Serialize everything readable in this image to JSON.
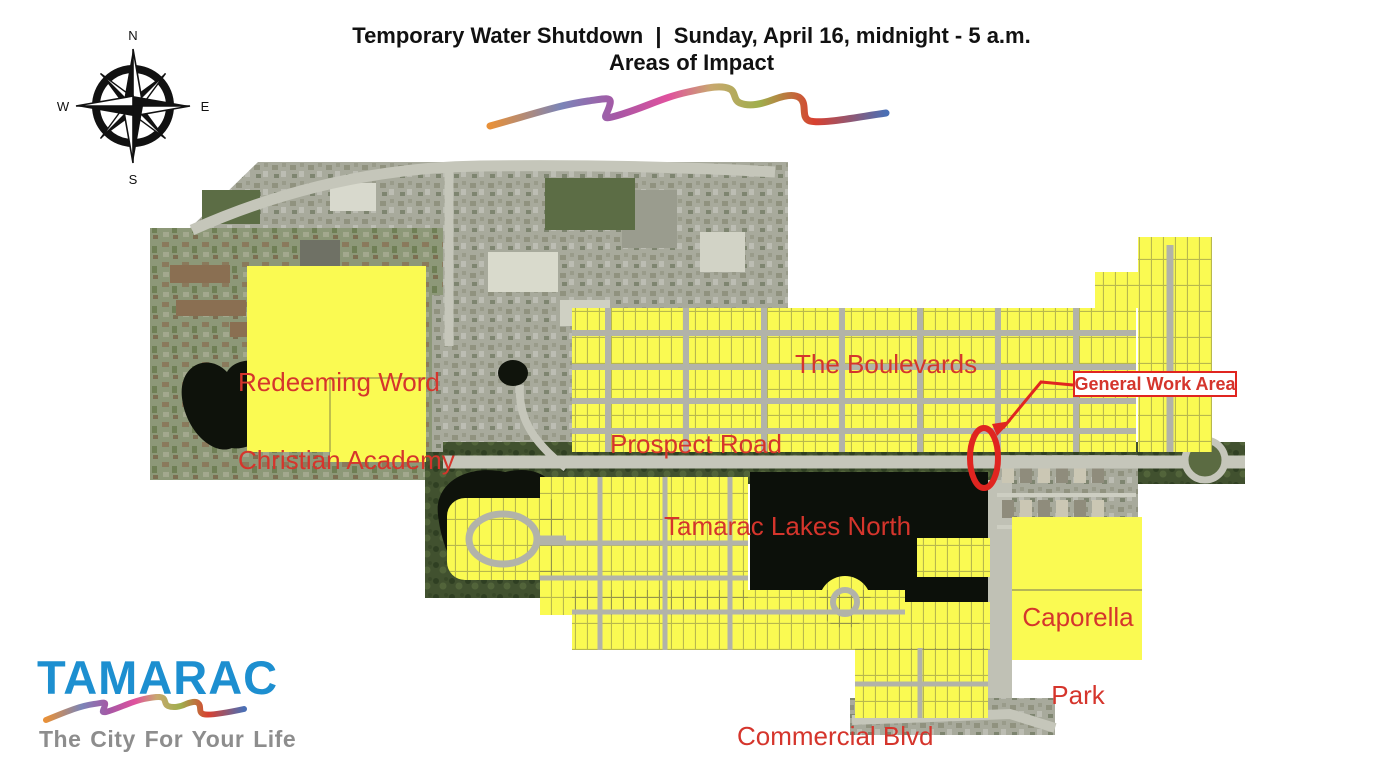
{
  "header": {
    "title_line1": "Temporary Water Shutdown  |  Sunday, April 16, midnight - 5 a.m.",
    "title_line2": "Areas of Impact"
  },
  "compass": {
    "north": "N",
    "east": "E",
    "south": "S",
    "west": "W"
  },
  "map": {
    "labels": {
      "redeeming_line1": "Redeeming Word",
      "redeeming_line2": "Christian Academy",
      "boulevards": "The Boulevards",
      "prospect_road": "Prospect Road",
      "tamarac_lakes_north": "Tamarac Lakes North",
      "caporella_line1": "Caporella",
      "caporella_line2": "Park",
      "commercial_blvd": "Commercial Blvd",
      "general_work_area": "General Work Area"
    }
  },
  "logo": {
    "name": "TAMARAC",
    "tagline": "The City For Your Life"
  },
  "colors": {
    "impact_highlight": "#FAFA52",
    "label_red": "#D5352C",
    "marker_red": "#E02520",
    "logo_blue": "#1D8FD0",
    "tagline_gray": "#8D8D8D",
    "title_black": "#111111"
  }
}
